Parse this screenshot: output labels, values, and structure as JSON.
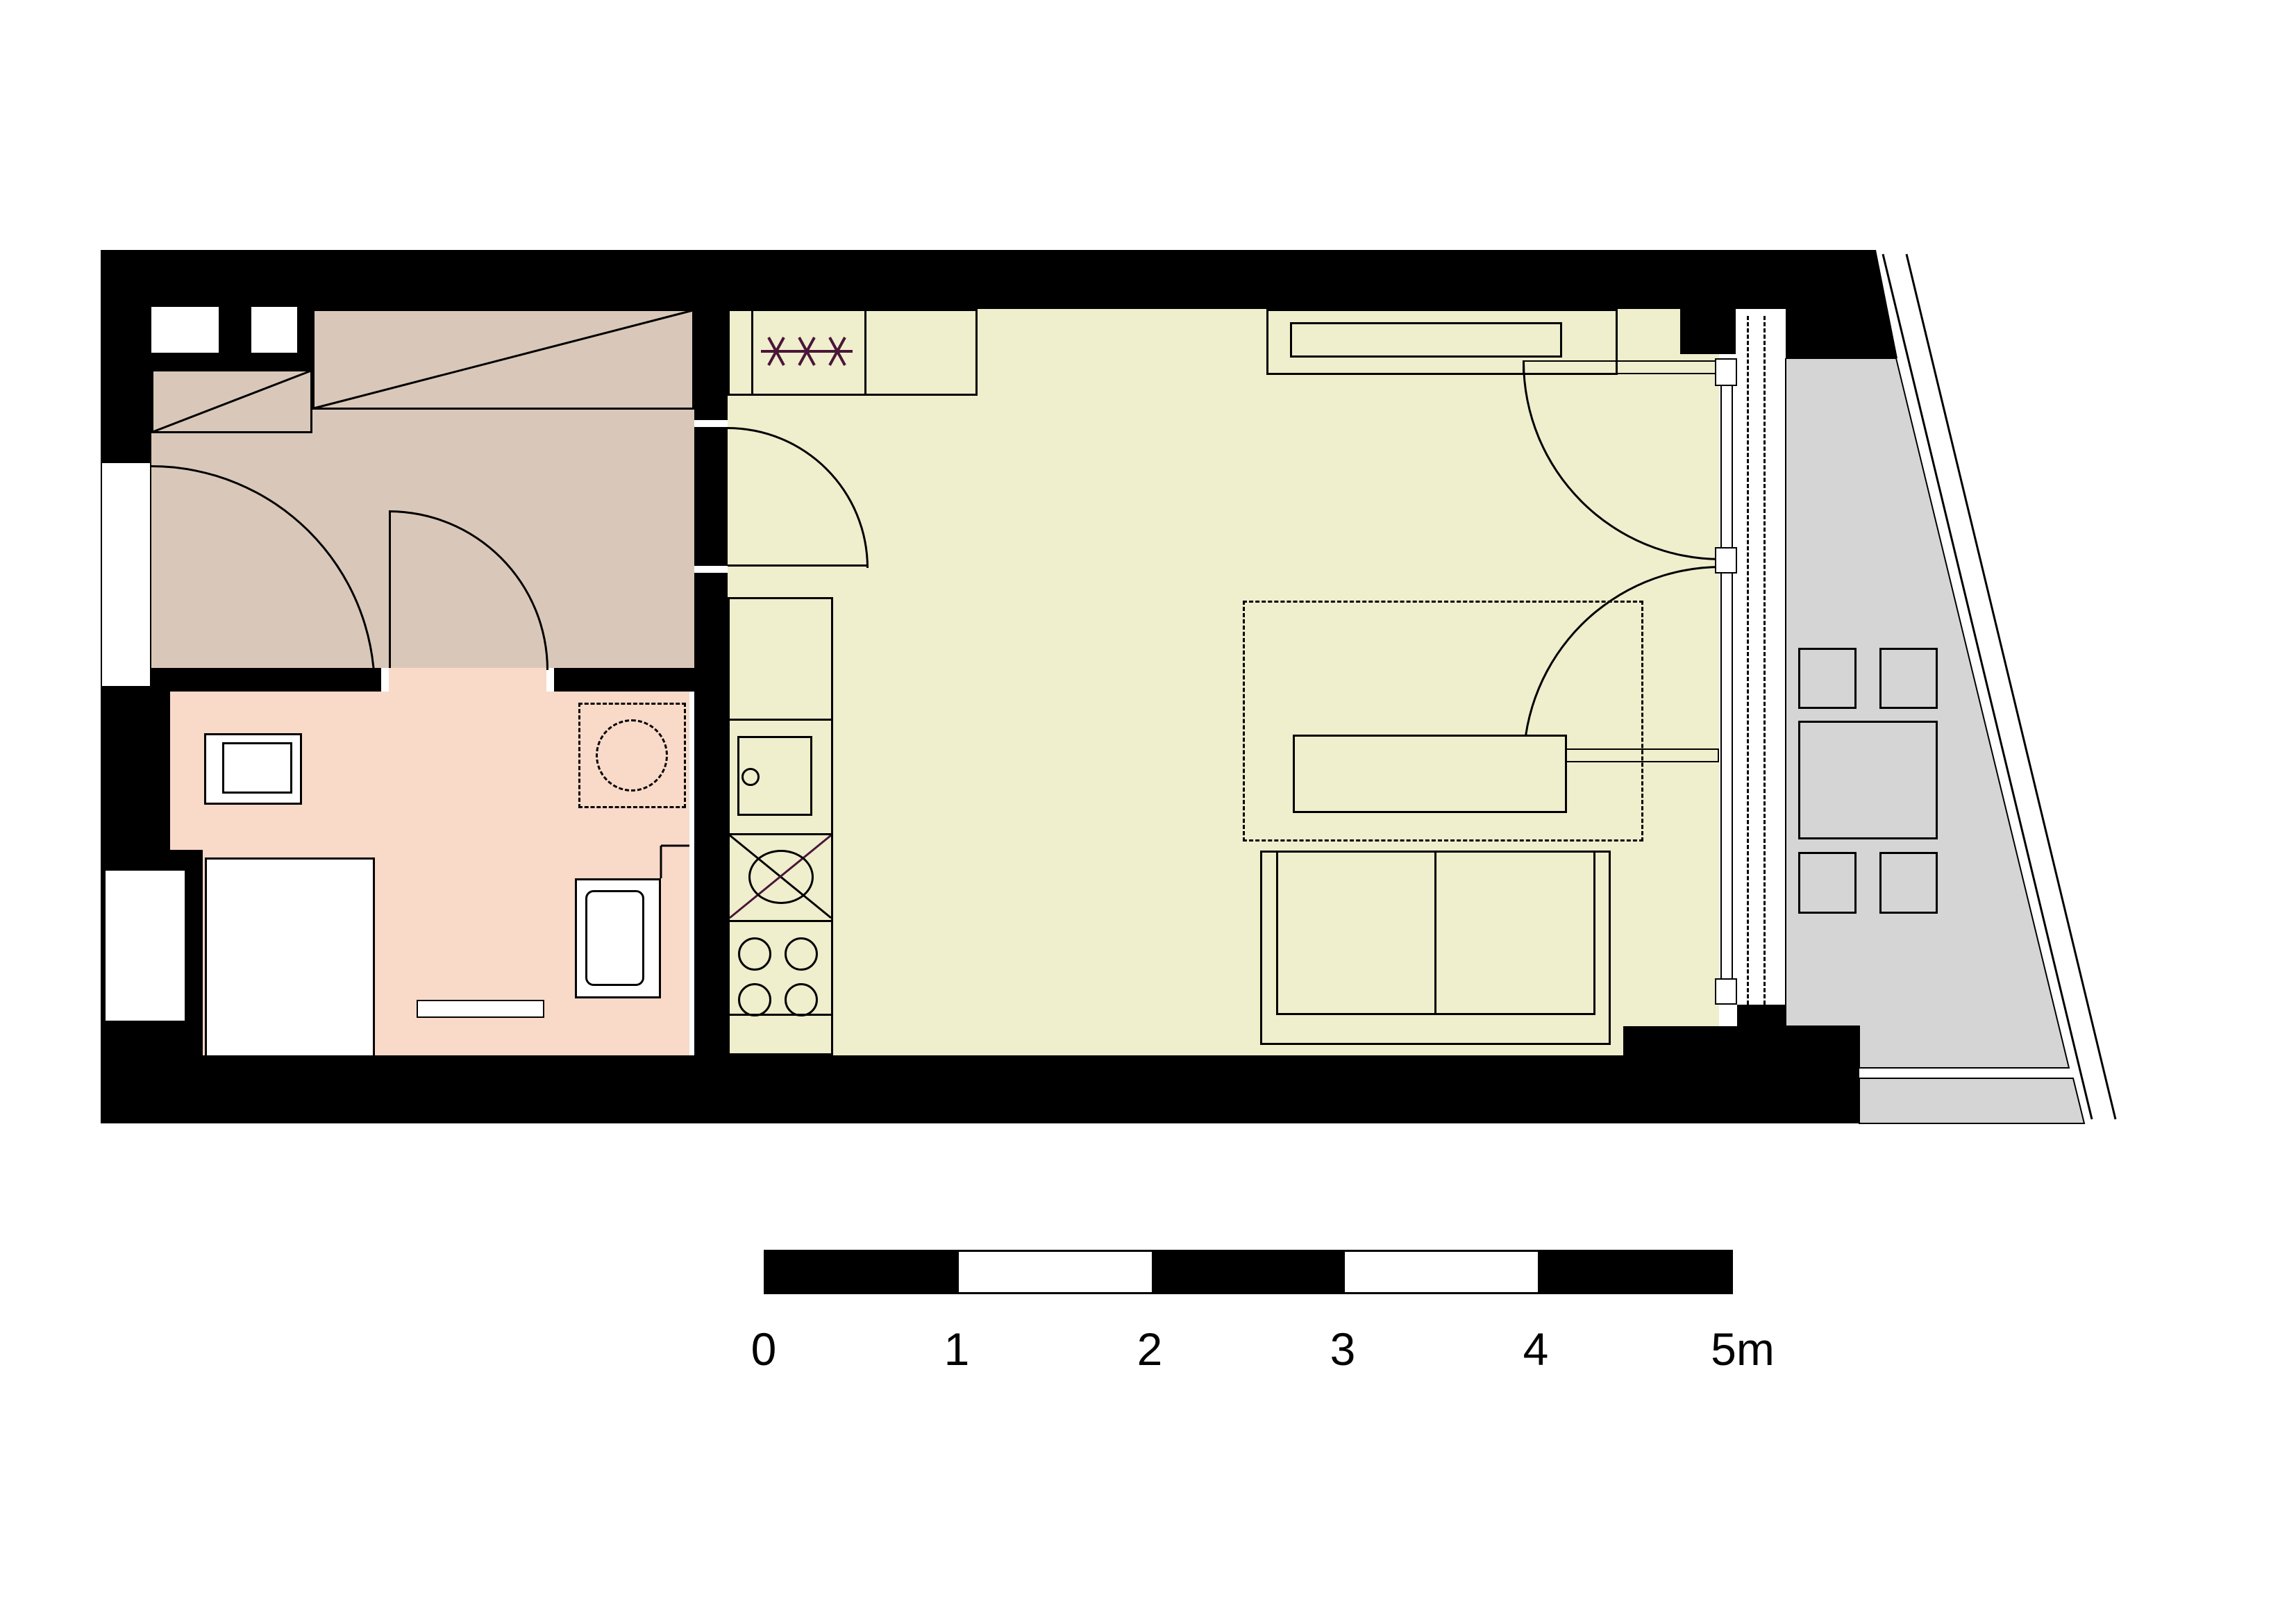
{
  "document": {
    "type": "apartment floor plan",
    "description": "studio apartment plan with entrance hall, bathroom, kitchen, living room and balcony"
  },
  "colors": {
    "wall": "#000000",
    "hall_floor": "#d9c8b9",
    "bathroom_floor": "#f9d9c8",
    "kitchen_living_floor": "#efeecd",
    "balcony_floor": "#d5d5d5",
    "symbol_accent": "#4a1638",
    "background": "#ffffff"
  },
  "rooms": [
    {
      "name": "entrance-hall",
      "color": "#d9c8b9"
    },
    {
      "name": "bathroom",
      "color": "#f9d9c8"
    },
    {
      "name": "kitchen-living-room",
      "color": "#efeecd"
    },
    {
      "name": "balcony",
      "color": "#d5d5d5"
    },
    {
      "name": "neighbor-balcony",
      "color": "#d5d5d5"
    }
  ],
  "fixtures": [
    "hall-wardrobe-small",
    "hall-wardrobe-large",
    "entrance-door",
    "bathroom-door",
    "kitchen-door",
    "shower",
    "washbasin",
    "toilet",
    "washing-machine-dashed",
    "radiator",
    "kitchen-upper-counter",
    "freezer-asterisks",
    "sink-cabinet",
    "kitchen-sink-crossed",
    "stove-four-burners",
    "living-wardrobe",
    "bed-dashed",
    "table",
    "sofa",
    "balcony-door-upper",
    "balcony-door-lower",
    "window-band",
    "balcony-table",
    "balcony-chairs",
    "railing"
  ],
  "scale_bar": {
    "unit": "meters",
    "labels": [
      "0",
      "1",
      "2",
      "3",
      "4",
      "5m"
    ],
    "segments": 5
  }
}
